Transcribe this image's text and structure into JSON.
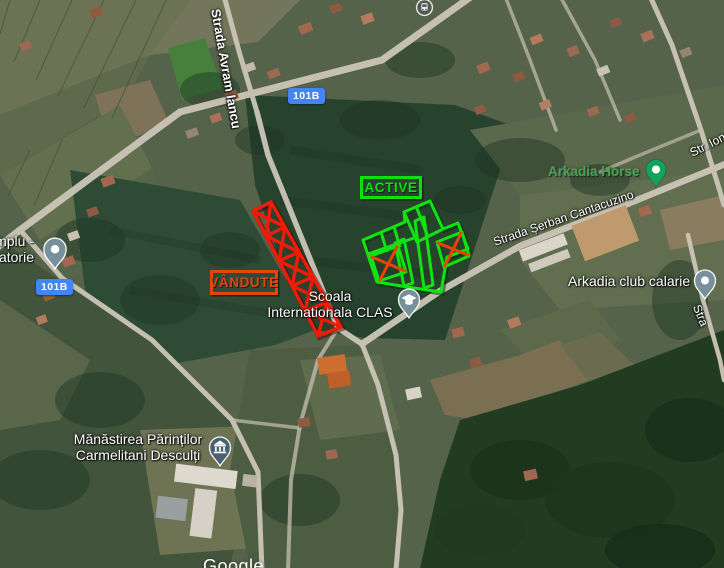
{
  "overlay": {
    "active": "ACTIVE",
    "vandute": "VÂNDUTE",
    "active_color": "#0ce10c",
    "sold_strip_color": "#f21b07",
    "vandute_box_color": "#e8430e"
  },
  "badges": {
    "route": "101B",
    "color": "#4285f4"
  },
  "roads": {
    "avram_iancu": "Strada Avram Iancu",
    "serban_cantacuzino": "Strada Șerban Cantacuzino",
    "str_ion": "Str. Ion",
    "stra_partial": "Stra"
  },
  "pois": {
    "arkadia_horse": "Arkadia Horse",
    "arkadia_club": "Arkadia club calarie",
    "scoala_line1": "Scoala",
    "scoala_line2": "Internationala CLAS",
    "monastery_line1": "Mănăstirea Părinților",
    "monastery_line2": "Carmelitani Desculți",
    "templu_line1": "mplu -",
    "templu_line2": "tatorie",
    "poi_green": "#46a24f"
  },
  "icons": {
    "bus_stop": "bus-stop-icon",
    "school": "graduation-cap-icon",
    "monastery": "columned-building-icon"
  },
  "watermark": "Google"
}
